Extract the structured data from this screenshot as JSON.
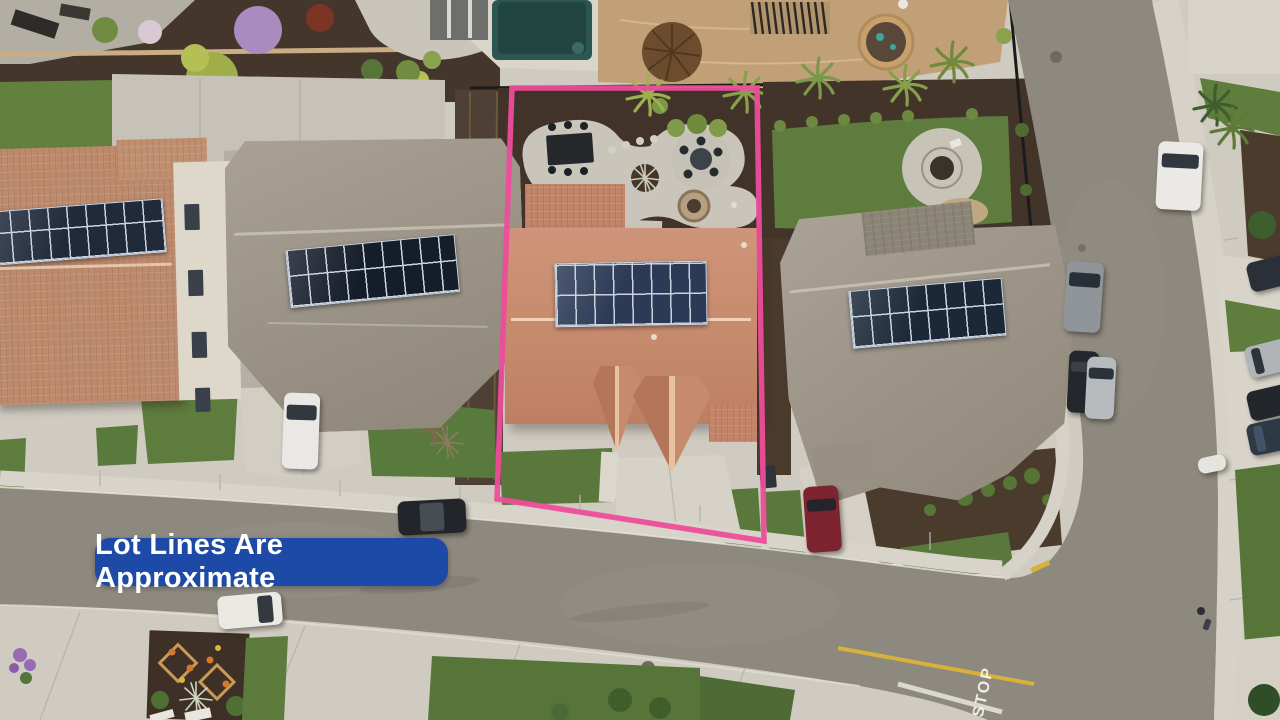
{
  "annotation": {
    "badge": {
      "label": "Lot Lines Are Approximate",
      "bg_color": "#1c4aa6",
      "text_color": "#ffffff"
    },
    "lot_line": {
      "color": "#ee4d9b"
    }
  },
  "road_markings": {
    "stop_label": "STOP",
    "stop_bar_color": "#e9e6dc",
    "center_line_color": "#d6b23a"
  },
  "palette": {
    "asphalt": "#8e897f",
    "concrete_sidewalk": "#d6d2c8",
    "lawn_green": "#5d7b3d",
    "mulch_brown": "#42332a",
    "pool_water": "#2b5651",
    "patio_tan": "#c2a077",
    "subject_roof_terracotta": "#c98f72",
    "neighbor_roof_gray": "#9d9588",
    "far_left_roof_terracotta": "#bd8a6c",
    "solar_panel_blue": "#2c3a56",
    "white_car": "#eae9e5",
    "red_car": "#7d2430"
  }
}
